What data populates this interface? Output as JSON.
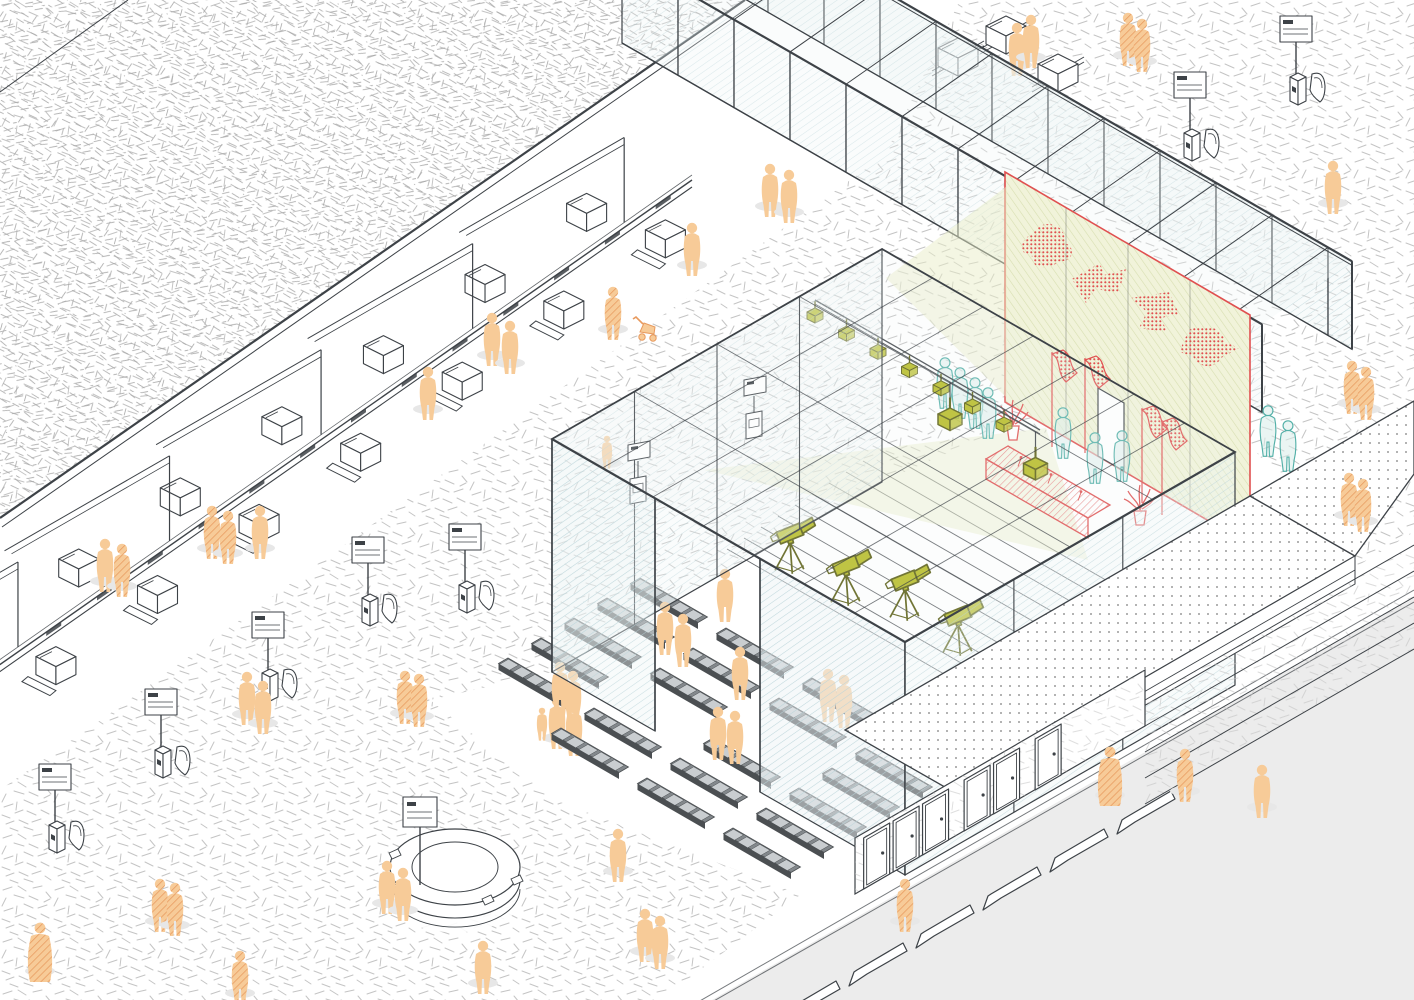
{
  "palette": {
    "bg": "#ffffff",
    "scribble": "#c4c4c4",
    "scribble_dark": "#a8a8a8",
    "line": "#3d4247",
    "glass_tint": "#edf4f5",
    "glass_hatch": "#b9d4d9",
    "street": "#ececec",
    "shadow": "#e7e7e7",
    "dots": "#9b9b9b",
    "orange": "#f7cb98",
    "orange_line": "#e89a5e",
    "teal": "#53b0a8",
    "teal_fill": "#d8ecea",
    "olive": "#b5ba1e",
    "olive_dark": "#565a0d",
    "red": "#e05050",
    "red_soft": "#e88787",
    "wall_bg": "#f1f3da",
    "wall_hatch": "#d4dcab",
    "cone": "#e9eec8",
    "bench_dark": "#4b4f52",
    "bench_mid": "#83888c"
  },
  "scene": {
    "ground": {
      "white_band": [
        [
          745,
          0
        ],
        [
          960,
          0
        ],
        [
          885,
          155
        ],
        [
          115,
          710
        ],
        [
          0,
          790
        ],
        [
          0,
          518
        ]
      ],
      "bowl": [
        [
          430,
          700
        ],
        [
          552,
          672
        ],
        [
          882,
          482
        ],
        [
          1000,
          430
        ],
        [
          1250,
          445
        ],
        [
          1350,
          560
        ],
        [
          1200,
          880
        ],
        [
          905,
          935
        ],
        [
          555,
          800
        ]
      ],
      "walkway": [
        [
          660,
          1000
        ],
        [
          820,
          880
        ],
        [
          1160,
          684
        ],
        [
          1414,
          532
        ],
        [
          1414,
          598
        ],
        [
          712,
          1000
        ]
      ],
      "street": [
        [
          712,
          1000
        ],
        [
          1414,
          598
        ],
        [
          1414,
          1000
        ]
      ],
      "curb": [
        [
          698,
          1002,
          1414,
          590
        ],
        [
          712,
          1002,
          1414,
          602
        ]
      ]
    },
    "roof": {
      "poly": [
        [
          0,
          0
        ],
        [
          745,
          0
        ],
        [
          0,
          518
        ]
      ],
      "edge": [
        745,
        0,
        0,
        518
      ],
      "edge2": [
        756,
        2,
        2,
        527
      ],
      "fold": [
        128,
        0,
        0,
        92
      ]
    },
    "counters": {
      "anchor": [
        692,
        180
      ],
      "dir": [
        -0.8192,
        0.5736
      ],
      "len": 845,
      "slot_t0": 26,
      "slot_dt": 62,
      "box_t0": 52,
      "box_dt": 62,
      "n_box": 13,
      "div_t0": 95,
      "div_dt": 185,
      "n_div": 5
    },
    "luggage_boxes": [
      [
        958,
        56
      ],
      [
        1006,
        34
      ],
      [
        1058,
        72
      ]
    ],
    "kiosks": [
      [
        57,
        852
      ],
      [
        163,
        777
      ],
      [
        270,
        700
      ],
      [
        370,
        625
      ],
      [
        467,
        612
      ],
      [
        1192,
        160
      ],
      [
        1298,
        104
      ]
    ],
    "corridor": {
      "x0": 712,
      "x1": 1352,
      "slope": 0.577,
      "far0": [
        790,
        -63
      ],
      "near_dx": -90,
      "near_dy": 63,
      "h": 88,
      "bay": 56
    },
    "pavilion": {
      "roof": [
        [
          552,
          439
        ],
        [
          882,
          249
        ],
        [
          1235,
          452
        ],
        [
          905,
          642
        ]
      ],
      "back_left_wall": [
        [
          552,
          439
        ],
        [
          882,
          249
        ],
        [
          882,
          482
        ],
        [
          552,
          672
        ]
      ],
      "front_left_beam": [
        552,
        439,
        905,
        642
      ],
      "front_left_pane1": [
        [
          552,
          439
        ],
        [
          655,
          498
        ],
        [
          655,
          731
        ],
        [
          552,
          672
        ]
      ],
      "front_left_pane2": [
        [
          760,
          559
        ],
        [
          905,
          642
        ],
        [
          905,
          875
        ],
        [
          760,
          792
        ]
      ],
      "front_left_posts": [
        [
          552,
          439
        ],
        [
          655,
          498
        ],
        [
          760,
          559
        ],
        [
          905,
          642
        ]
      ],
      "front_right_wall": [
        [
          905,
          642
        ],
        [
          1235,
          452
        ],
        [
          1235,
          685
        ],
        [
          905,
          875
        ]
      ],
      "height": 233,
      "amphi": {
        "p0": [
          880,
          450
        ],
        "step": [
          -17,
          11
        ],
        "n": 10,
        "len": [
          330,
          190
        ]
      },
      "benches": {
        "origin": [
          640,
          578
        ],
        "col": [
          86,
          50
        ],
        "row": [
          -33,
          20
        ],
        "rows": 6,
        "cols": 4,
        "skip": [
          [
            2,
            2
          ],
          [
            3,
            1
          ],
          [
            5,
            0
          ]
        ]
      },
      "monitors": [
        [
          628,
          445
        ],
        [
          744,
          380
        ]
      ],
      "truss": {
        "a": [
          815,
          300
        ],
        "b": [
          1040,
          430
        ],
        "lights": [
          0,
          0.14,
          0.28,
          0.42,
          0.56,
          0.7,
          0.84
        ],
        "bigs": [
          0.6,
          0.98
        ]
      },
      "cameras": [
        [
          790,
          560
        ],
        [
          846,
          592
        ],
        [
          905,
          607
        ],
        [
          958,
          642
        ]
      ],
      "cones": {
        "wall": [
          [
            886,
            278
          ],
          [
            1007,
            186
          ],
          [
            1007,
            398
          ]
        ],
        "floor": [
          [
            704,
            470
          ],
          [
            1046,
            428
          ],
          [
            1088,
            560
          ]
        ]
      }
    },
    "red_wall": {
      "pts": [
        [
          1005,
          172
        ],
        [
          1250,
          315
        ],
        [
          1250,
          545
        ],
        [
          1005,
          402
        ]
      ],
      "mullions": [
        1066,
        1128,
        1190
      ],
      "door": [
        [
          1098,
          388
        ],
        [
          1124,
          403
        ],
        [
          1124,
          471
        ],
        [
          1098,
          456
        ]
      ],
      "blobs": [
        [
          1038,
          247,
          1
        ],
        [
          1096,
          285,
          2
        ],
        [
          1151,
          312,
          3
        ],
        [
          1205,
          348,
          4
        ]
      ]
    },
    "stage": {
      "desk_top": [
        [
          1008,
          446
        ],
        [
          1110,
          505
        ],
        [
          1088,
          518
        ],
        [
          986,
          459
        ]
      ],
      "desk_front": [
        [
          986,
          459
        ],
        [
          1088,
          518
        ],
        [
          1088,
          538
        ],
        [
          986,
          479
        ]
      ],
      "mic_a": [
        998,
        455
      ],
      "mic_b": [
        1098,
        512
      ],
      "mics": [
        0.2,
        0.5,
        0.8
      ],
      "plants": [
        [
          1013,
          440
        ],
        [
          1140,
          525
        ]
      ],
      "flags": [
        [
          1052,
          352
        ],
        [
          1085,
          358
        ],
        [
          1142,
          408
        ],
        [
          1162,
          420
        ]
      ]
    },
    "platform": {
      "terrace": [
        [
          845,
          730
        ],
        [
          1250,
          496
        ],
        [
          1355,
          556
        ],
        [
          950,
          790
        ]
      ],
      "terrace2": [
        [
          1250,
          496
        ],
        [
          1414,
          401
        ],
        [
          1414,
          474
        ],
        [
          1355,
          556
        ]
      ],
      "stepband": [
        [
          950,
          790
        ],
        [
          1355,
          556
        ],
        [
          1355,
          584
        ],
        [
          950,
          818
        ]
      ],
      "doorwall": [
        [
          855,
          838
        ],
        [
          1145,
          670
        ],
        [
          1145,
          726
        ],
        [
          855,
          894
        ]
      ],
      "doors": [
        10,
        44,
        78,
        126,
        160,
        208
      ],
      "stairs": {
        "x0": 1145,
        "y0": 700,
        "dy": 26,
        "n": 4,
        "x1": 1414,
        "drop": 155
      }
    },
    "circle_desk": {
      "c": [
        455,
        880
      ],
      "rx": 65,
      "ry": 38,
      "wall": 26,
      "sign": [
        420,
        815
      ],
      "items": [
        [
          399,
          899
        ],
        [
          516,
          893
        ],
        [
          487,
          913
        ],
        [
          394,
          867
        ]
      ]
    },
    "wedges": {
      "start": [
        790,
        1008
      ],
      "step": [
        67,
        -38
      ],
      "n": 6
    },
    "people": {
      "plaza": [
        [
          1017,
          62,
          "a",
          "s"
        ],
        [
          1031,
          54,
          "a",
          "s"
        ],
        [
          1128,
          52,
          "a",
          "h"
        ],
        [
          1142,
          58,
          "a",
          "h"
        ],
        [
          1333,
          200,
          "a",
          "s"
        ],
        [
          770,
          203,
          "a",
          "s"
        ],
        [
          789,
          209,
          "a",
          "s"
        ],
        [
          692,
          262,
          "a",
          "s"
        ],
        [
          613,
          326,
          "a",
          "h"
        ],
        [
          428,
          406,
          "a",
          "s"
        ],
        [
          492,
          352,
          "a",
          "s"
        ],
        [
          510,
          360,
          "a",
          "s"
        ],
        [
          607,
          460,
          "c",
          "s"
        ],
        [
          212,
          545,
          "a",
          "h"
        ],
        [
          228,
          550,
          "a",
          "h"
        ],
        [
          260,
          545,
          "a",
          "s"
        ],
        [
          105,
          578,
          "a",
          "s"
        ],
        [
          122,
          583,
          "a",
          "h"
        ],
        [
          247,
          711,
          "a",
          "s"
        ],
        [
          263,
          720,
          "a",
          "s"
        ],
        [
          405,
          710,
          "a",
          "h"
        ],
        [
          419,
          713,
          "a",
          "h"
        ],
        [
          557,
          735,
          "a",
          "s"
        ],
        [
          574,
          742,
          "a",
          "s"
        ],
        [
          483,
          980,
          "a",
          "s"
        ],
        [
          645,
          948,
          "a",
          "s"
        ],
        [
          660,
          955,
          "a",
          "s"
        ],
        [
          40,
          968,
          "coat",
          "h"
        ],
        [
          160,
          918,
          "a",
          "h"
        ],
        [
          175,
          922,
          "a",
          "h"
        ],
        [
          240,
          990,
          "a",
          "h"
        ],
        [
          618,
          868,
          "a",
          "s"
        ]
      ],
      "stroller": [
        640,
        340
      ],
      "bench": [
        [
          725,
          608,
          "a",
          "s"
        ],
        [
          665,
          641,
          "a",
          "s"
        ],
        [
          683,
          653,
          "a",
          "s"
        ],
        [
          740,
          686,
          "a",
          "s"
        ],
        [
          718,
          746,
          "a",
          "s"
        ],
        [
          735,
          750,
          "a",
          "s"
        ],
        [
          560,
          701,
          "a",
          "s"
        ],
        [
          573,
          710,
          "a",
          "s"
        ],
        [
          828,
          708,
          "a",
          "s"
        ],
        [
          844,
          714,
          "a",
          "s"
        ],
        [
          542,
          732,
          "c",
          "s"
        ]
      ],
      "teal": [
        [
          945,
          395
        ],
        [
          960,
          405
        ],
        [
          975,
          415
        ],
        [
          988,
          425
        ],
        [
          1063,
          445
        ],
        [
          1095,
          470
        ],
        [
          1122,
          468
        ],
        [
          1268,
          443
        ],
        [
          1288,
          458
        ]
      ],
      "walkway": [
        [
          1110,
          792,
          "coat",
          "h"
        ],
        [
          1185,
          788,
          "a",
          "h"
        ],
        [
          905,
          918,
          "a",
          "h"
        ],
        [
          1262,
          804,
          "a",
          "s"
        ]
      ],
      "platform": [
        [
          1352,
          400,
          "a",
          "h"
        ],
        [
          1366,
          406,
          "a",
          "h"
        ],
        [
          1349,
          512,
          "a",
          "h"
        ],
        [
          1363,
          518,
          "a",
          "h"
        ]
      ],
      "circle": [
        [
          387,
          900,
          "a",
          "s"
        ],
        [
          403,
          907,
          "a",
          "s"
        ]
      ]
    }
  }
}
